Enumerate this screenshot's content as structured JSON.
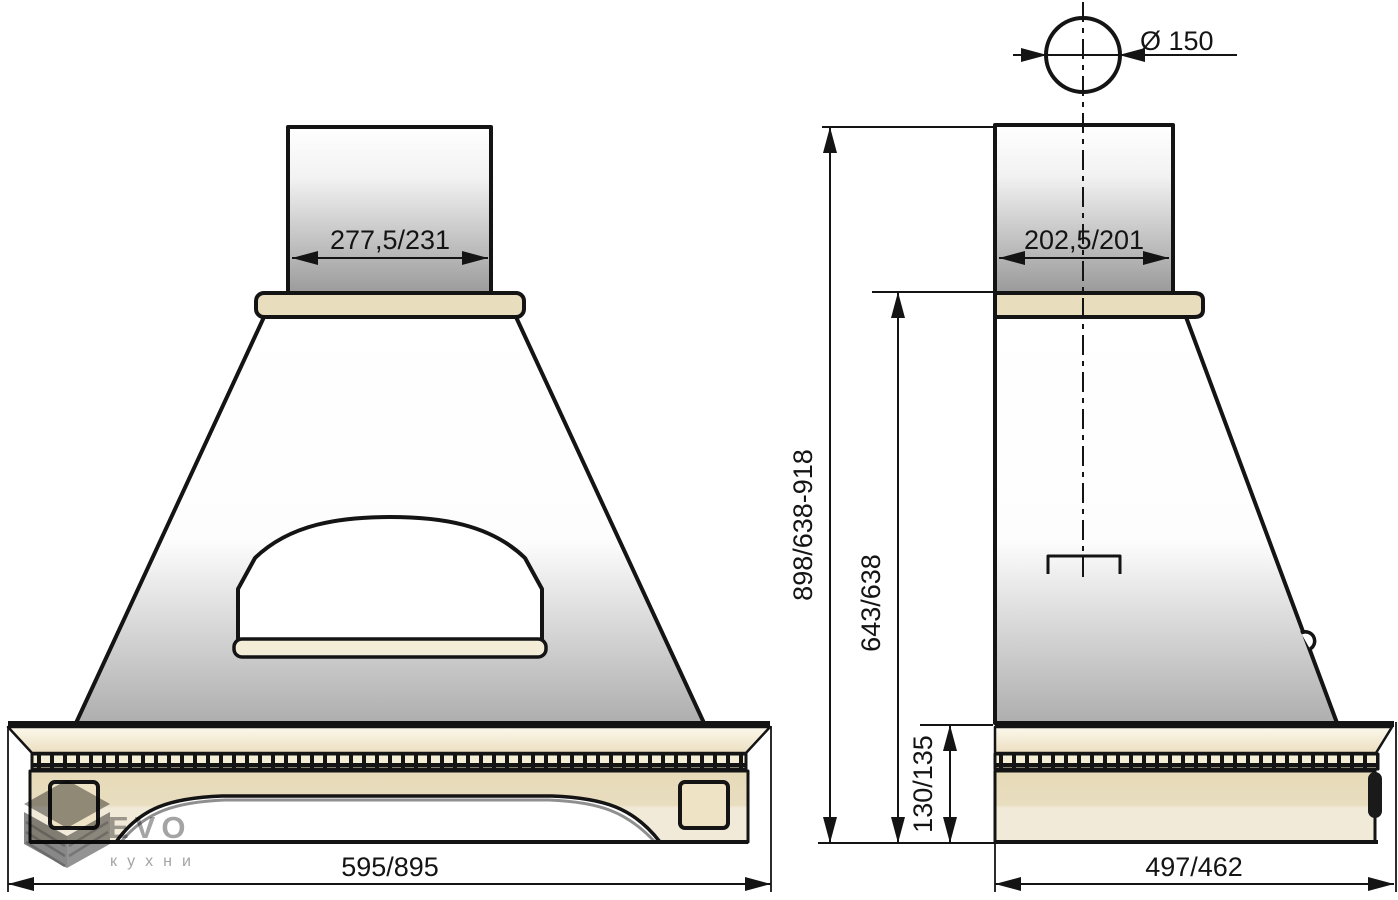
{
  "watermark": {
    "brand": "EVO",
    "subtitle": "кухни"
  },
  "front_view": {
    "chimney_width": "277,5/231",
    "overall_width": "595/895"
  },
  "side_view": {
    "duct_diameter": "Ø 150",
    "chimney_depth": "202,5/201",
    "overall_height": "898/638-918",
    "body_height": "643/638",
    "plinth_height": "130/135",
    "overall_depth": "497/462"
  },
  "colors": {
    "outline": "#141414",
    "cap_cream": "#e8ddbd",
    "panel_cream_dark": "#e6dab8",
    "panel_cream_light": "#f1ead8",
    "dentil_cream": "#f5eed6",
    "metal_gray": "#989898",
    "watermark_gray": "#9c9c9c"
  }
}
